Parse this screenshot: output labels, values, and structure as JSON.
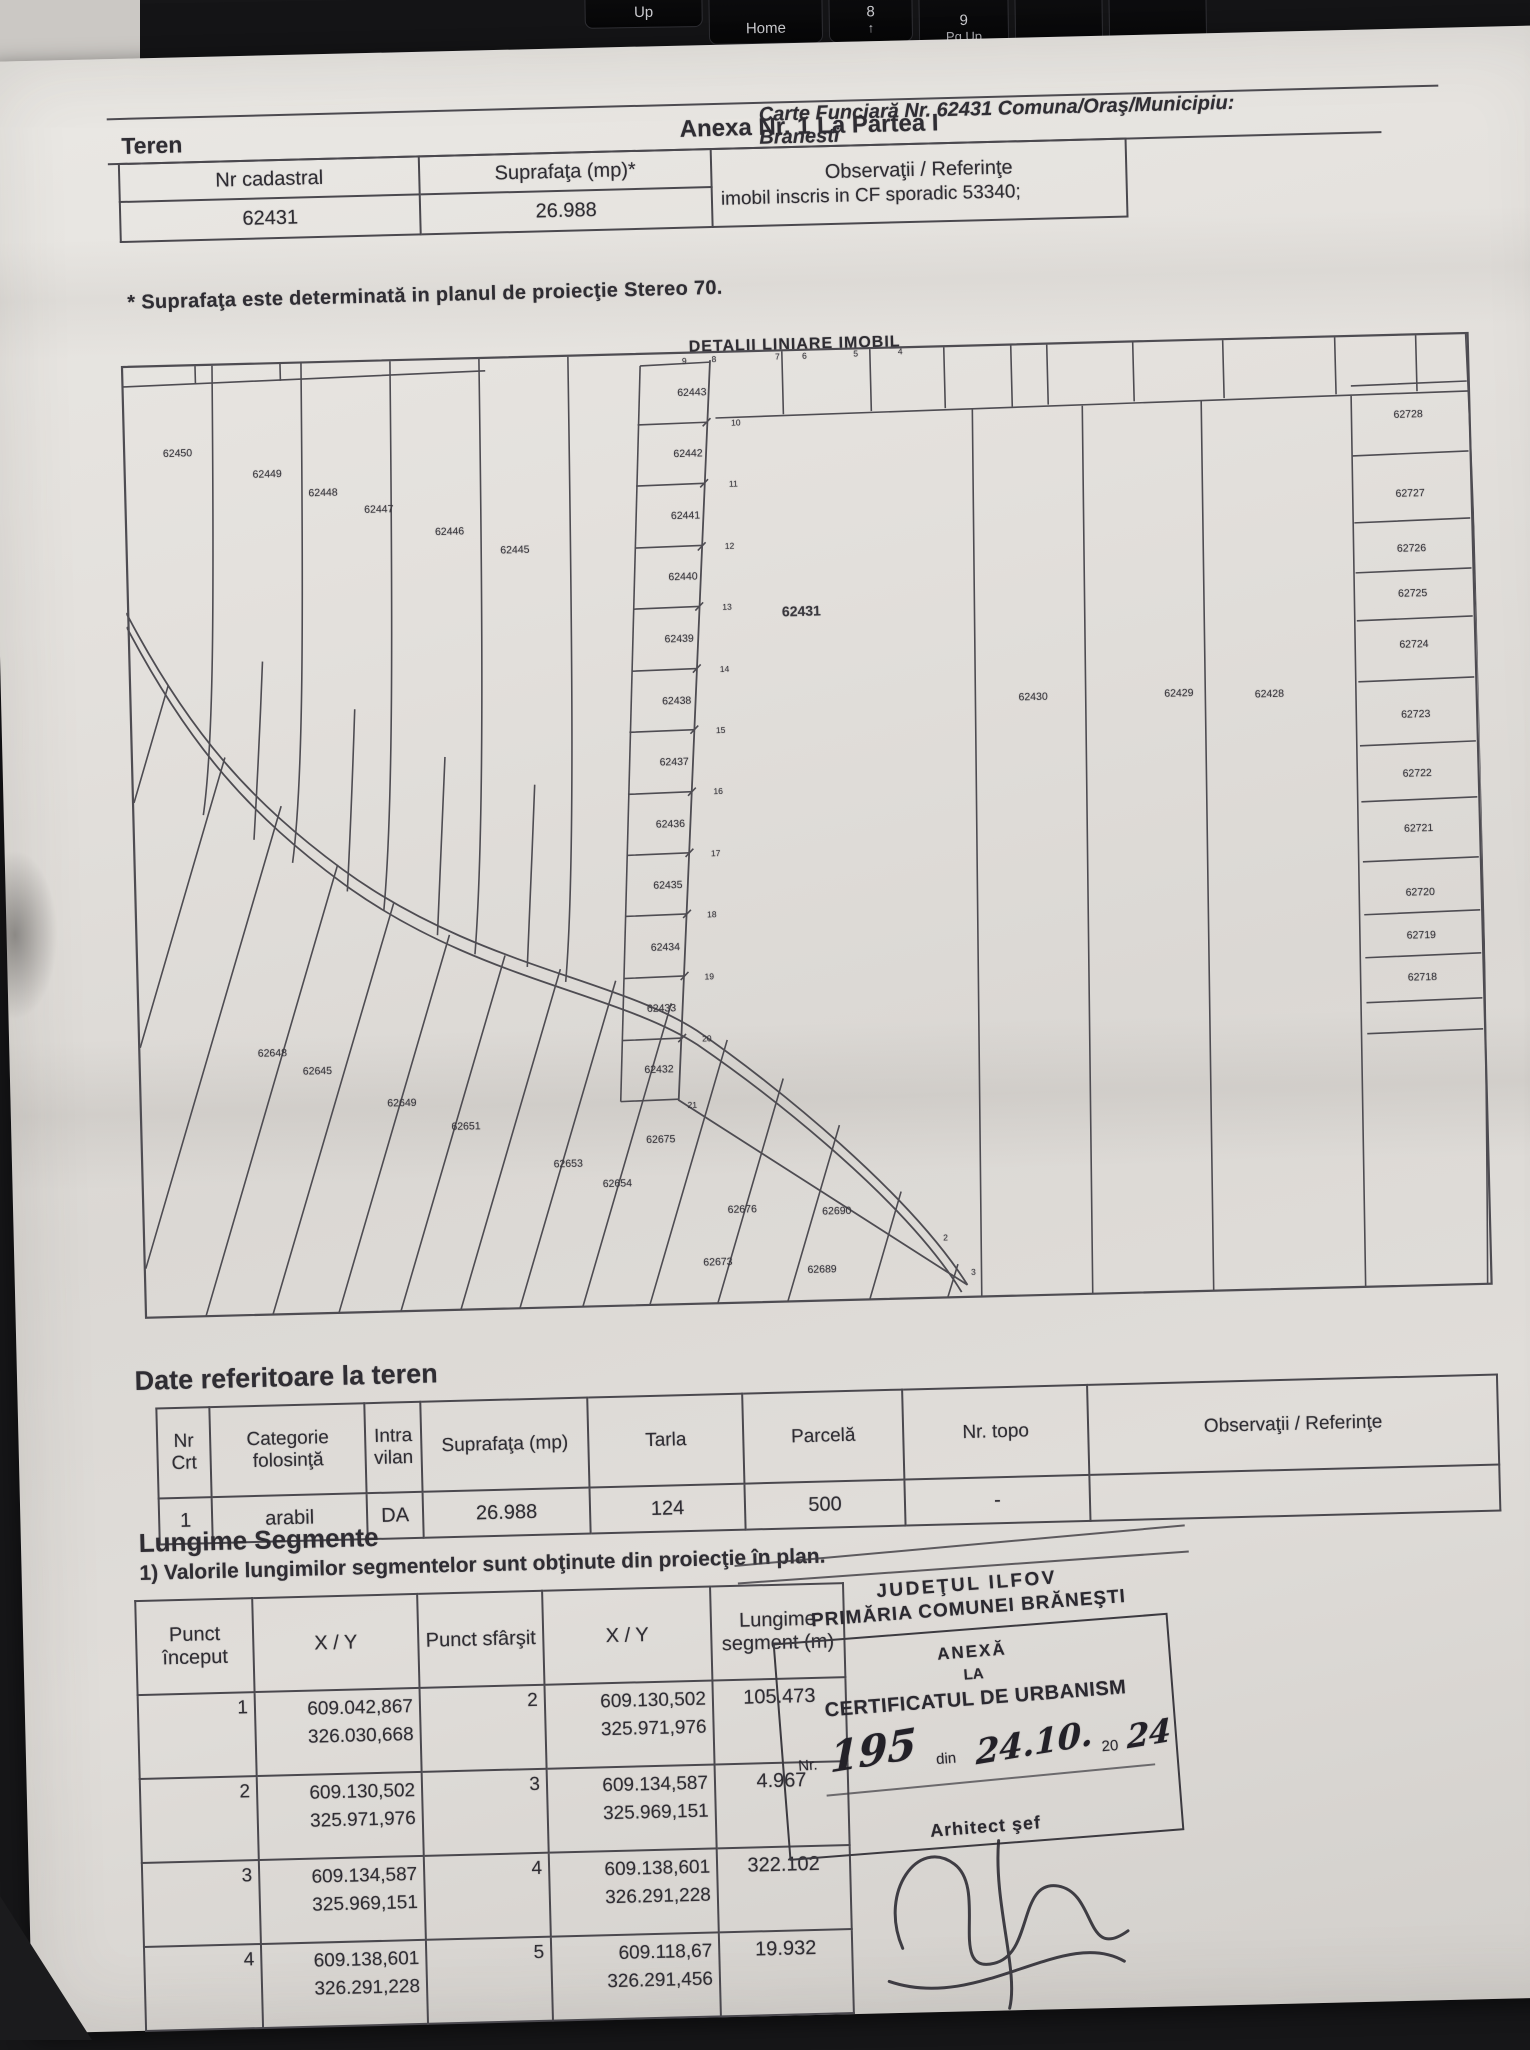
{
  "colors": {
    "ink": "#2f2d33",
    "paper": "#e0ddd9",
    "keyboard": "#141416",
    "stamp_ink": "#2b2930"
  },
  "photo": {
    "keyboard_keys": [
      {
        "id": "up-key",
        "label": "Up",
        "x": 585,
        "y": -26,
        "w": 116,
        "h": 50
      },
      {
        "id": "home-key",
        "label": "Home",
        "x": 709,
        "y": -18,
        "w": 112,
        "h": 60
      },
      {
        "id": "num8-key",
        "label": "8",
        "sub": "↑",
        "x": 829,
        "y": -22,
        "w": 82,
        "h": 64
      },
      {
        "id": "num9-key",
        "label": "9",
        "sub": "Pg Up",
        "x": 919,
        "y": -16,
        "w": 88,
        "h": 68
      },
      {
        "id": "plus-key",
        "label": "+",
        "x": 1015,
        "y": -8,
        "w": 86,
        "h": 72
      },
      {
        "id": "blank-key",
        "label": "",
        "x": 1109,
        "y": -4,
        "w": 96,
        "h": 72
      }
    ]
  },
  "header": {
    "carte_funciara": "Carte Funciară Nr. 62431 Comuna/Oraş/Municipiu: Branesti",
    "anexa": "Anexa Nr. 1 La Partea I",
    "section": "Teren"
  },
  "teren_table": {
    "col_nr_cadastral": "Nr cadastral",
    "col_suprafata": "Suprafaţa (mp)*",
    "col_observatii": "Observaţii / Referinţe",
    "nr_cadastral": "62431",
    "suprafata": "26.988",
    "observatii": "imobil inscris in CF sporadic 53340;",
    "footnote": "* Suprafaţa este determinată in planul de proiecţie Stereo 70."
  },
  "plan": {
    "title": "DETALII LINIARE IMOBIL",
    "labels": [
      {
        "t": "62450",
        "x": 4.1,
        "y": 9.4
      },
      {
        "t": "62449",
        "x": 10.7,
        "y": 11.8
      },
      {
        "t": "62448",
        "x": 14.8,
        "y": 13.9
      },
      {
        "t": "62447",
        "x": 18.9,
        "y": 15.8
      },
      {
        "t": "62446",
        "x": 24.1,
        "y": 18.3
      },
      {
        "t": "62445",
        "x": 28.9,
        "y": 20.4
      },
      {
        "t": "62443",
        "x": 42.3,
        "y": 4.4
      },
      {
        "t": "62442",
        "x": 41.9,
        "y": 10.8
      },
      {
        "t": "62441",
        "x": 41.6,
        "y": 17.3
      },
      {
        "t": "62440",
        "x": 41.3,
        "y": 23.7
      },
      {
        "t": "62439",
        "x": 40.9,
        "y": 30.2
      },
      {
        "t": "62438",
        "x": 40.6,
        "y": 36.6
      },
      {
        "t": "62437",
        "x": 40.3,
        "y": 43.0
      },
      {
        "t": "62436",
        "x": 39.9,
        "y": 49.5
      },
      {
        "t": "62435",
        "x": 39.6,
        "y": 55.9
      },
      {
        "t": "62434",
        "x": 39.3,
        "y": 62.4
      },
      {
        "t": "62433",
        "x": 38.9,
        "y": 68.8
      },
      {
        "t": "62432",
        "x": 38.6,
        "y": 75.2
      },
      {
        "t": "62431",
        "x": 50.0,
        "y": 27.5,
        "big": true
      },
      {
        "t": "62430",
        "x": 67.0,
        "y": 37.2
      },
      {
        "t": "62429",
        "x": 77.8,
        "y": 37.2
      },
      {
        "t": "62428",
        "x": 84.5,
        "y": 37.5
      },
      {
        "t": "62728",
        "x": 95.3,
        "y": 8.6
      },
      {
        "t": "62727",
        "x": 95.3,
        "y": 16.9
      },
      {
        "t": "62726",
        "x": 95.3,
        "y": 22.6
      },
      {
        "t": "62725",
        "x": 95.3,
        "y": 27.3
      },
      {
        "t": "62724",
        "x": 95.3,
        "y": 32.7
      },
      {
        "t": "62723",
        "x": 95.3,
        "y": 40.0
      },
      {
        "t": "62722",
        "x": 95.3,
        "y": 46.2
      },
      {
        "t": "62721",
        "x": 95.3,
        "y": 51.9
      },
      {
        "t": "62720",
        "x": 95.3,
        "y": 58.6
      },
      {
        "t": "62719",
        "x": 95.3,
        "y": 63.1
      },
      {
        "t": "62718",
        "x": 95.3,
        "y": 67.5
      },
      {
        "t": "62648",
        "x": 10.0,
        "y": 72.5
      },
      {
        "t": "62645",
        "x": 13.3,
        "y": 74.5
      },
      {
        "t": "62649",
        "x": 19.5,
        "y": 78.0
      },
      {
        "t": "62651",
        "x": 24.2,
        "y": 80.6
      },
      {
        "t": "62653",
        "x": 31.7,
        "y": 84.8
      },
      {
        "t": "62654",
        "x": 35.3,
        "y": 87.0
      },
      {
        "t": "62675",
        "x": 38.6,
        "y": 82.5
      },
      {
        "t": "62676",
        "x": 44.5,
        "y": 90.0
      },
      {
        "t": "62690",
        "x": 51.5,
        "y": 90.5
      },
      {
        "t": "62673",
        "x": 42.6,
        "y": 95.5
      },
      {
        "t": "62689",
        "x": 50.3,
        "y": 96.5
      }
    ],
    "vertices": [
      {
        "t": "9",
        "x": 41.8,
        "y": 1.0
      },
      {
        "t": "8",
        "x": 44.0,
        "y": 0.9
      },
      {
        "t": "7",
        "x": 48.7,
        "y": 0.8
      },
      {
        "t": "6",
        "x": 50.7,
        "y": 0.8
      },
      {
        "t": "5",
        "x": 54.5,
        "y": 0.7
      },
      {
        "t": "4",
        "x": 57.8,
        "y": 0.6
      },
      {
        "t": "10",
        "x": 45.5,
        "y": 7.6
      },
      {
        "t": "11",
        "x": 45.2,
        "y": 14.0
      },
      {
        "t": "12",
        "x": 44.8,
        "y": 20.5
      },
      {
        "t": "13",
        "x": 44.5,
        "y": 26.9
      },
      {
        "t": "14",
        "x": 44.2,
        "y": 33.4
      },
      {
        "t": "15",
        "x": 43.8,
        "y": 39.8
      },
      {
        "t": "16",
        "x": 43.5,
        "y": 46.2
      },
      {
        "t": "17",
        "x": 43.2,
        "y": 52.7
      },
      {
        "t": "18",
        "x": 42.8,
        "y": 59.1
      },
      {
        "t": "19",
        "x": 42.5,
        "y": 65.5
      },
      {
        "t": "20",
        "x": 42.2,
        "y": 72.0
      },
      {
        "t": "21",
        "x": 41.0,
        "y": 79.0
      },
      {
        "t": "2",
        "x": 59.5,
        "y": 93.5
      },
      {
        "t": "3",
        "x": 61.5,
        "y": 97.2
      }
    ]
  },
  "date_teren": {
    "heading": "Date referitoare la teren",
    "headers": [
      "Nr Crt",
      "Categorie folosinţă",
      "Intra vilan",
      "Suprafaţa (mp)",
      "Tarla",
      "Parcelă",
      "Nr. topo",
      "Observaţii / Referinţe"
    ],
    "row": [
      "1",
      "arabil",
      "DA",
      "26.988",
      "124",
      "500",
      "-",
      ""
    ]
  },
  "segmente": {
    "heading": "Lungime Segmente",
    "note": "1) Valorile lungimilor segmentelor sunt obţinute din proiecţie în plan.",
    "headers": [
      "Punct început",
      "X / Y",
      "Punct sfârşit",
      "X / Y",
      "Lungime segment (m)"
    ],
    "rows": [
      {
        "p1": "1",
        "xy1": [
          "609.042,867",
          "326.030,668"
        ],
        "p2": "2",
        "xy2": [
          "609.130,502",
          "325.971,976"
        ],
        "len": "105.473"
      },
      {
        "p1": "2",
        "xy1": [
          "609.130,502",
          "325.971,976"
        ],
        "p2": "3",
        "xy2": [
          "609.134,587",
          "325.969,151"
        ],
        "len": "4.967"
      },
      {
        "p1": "3",
        "xy1": [
          "609.134,587",
          "325.969,151"
        ],
        "p2": "4",
        "xy2": [
          "609.138,601",
          "326.291,228"
        ],
        "len": "322.102"
      },
      {
        "p1": "4",
        "xy1": [
          "609.138,601",
          "326.291,228"
        ],
        "p2": "5",
        "xy2": [
          "609.118,67",
          "326.291,456"
        ],
        "len": "19.932"
      }
    ]
  },
  "stamp": {
    "judet": "JUDEŢUL ILFOV",
    "primaria": "PRIMĂRIA COMUNEI BRĂNEŞTI",
    "anexa": "ANEXĂ",
    "la": "LA",
    "certificat": "CERTIFICATUL DE URBANISM",
    "nr_label": "Nr.",
    "nr_value": "195",
    "din_label": "din",
    "date_value": "24.10.",
    "year_prefix": "20",
    "year_value": "24",
    "signer": "Arhitect şef"
  }
}
